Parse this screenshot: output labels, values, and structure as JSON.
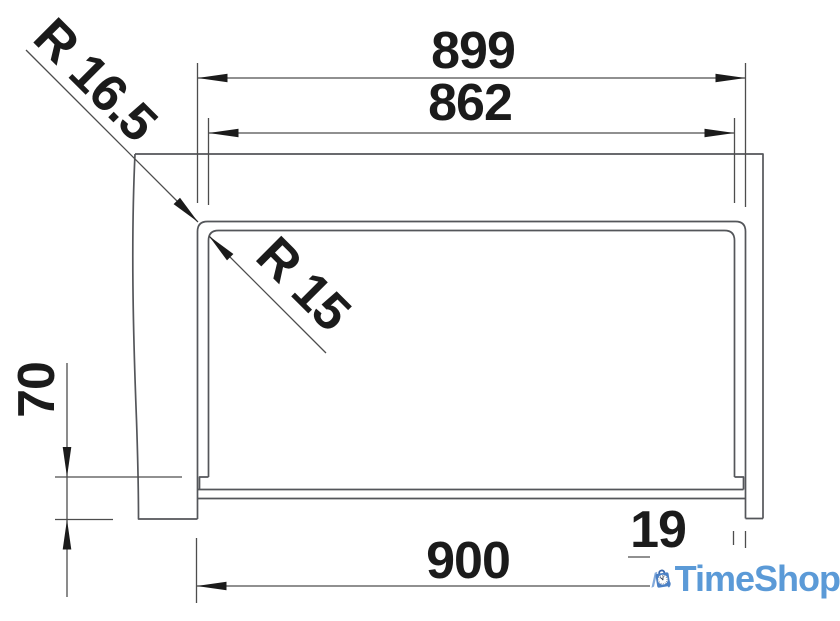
{
  "diagram": {
    "labels": {
      "overall_width": "899",
      "inner_width": "862",
      "outer_radius": "R 16.5",
      "inner_radius": "R 15",
      "front_height": "70",
      "base_width": "900",
      "rim_width": "19"
    },
    "line_color": "#54565a",
    "dimension_line_color": "#4d4d4d",
    "dimension_text_color": "#1b1b1b"
  },
  "branding": {
    "logo_text": "TimeShop",
    "text_color": "#5b9ad7",
    "bag_color": "#4b80c4",
    "handle_color": "#3a67ac",
    "stripe_color": "#83aadb",
    "clock_face_color": "#ffffff",
    "clock_marks_color": "#2b3b55"
  }
}
